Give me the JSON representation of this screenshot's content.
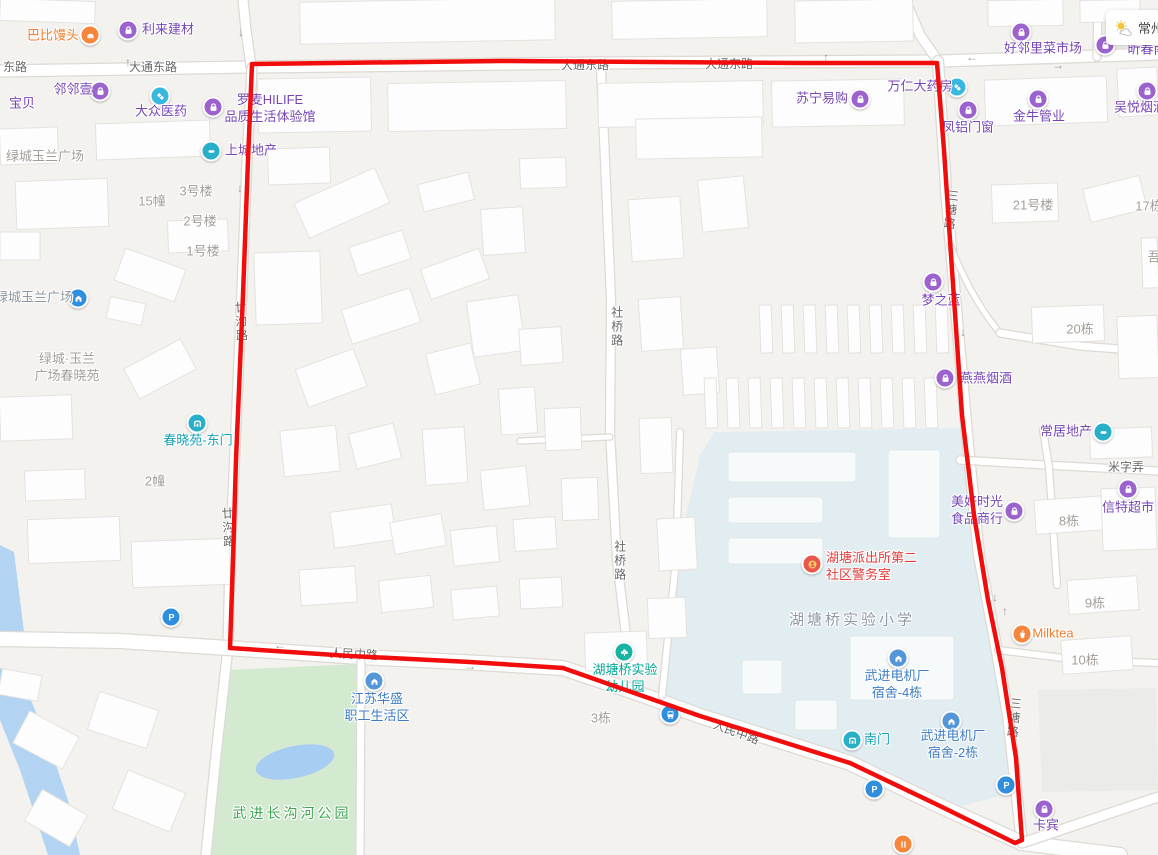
{
  "map": {
    "weather": {
      "city": "常州"
    },
    "red_route": {
      "path": "M252,64 L500,61 L800,63 L937,63 L944,150 L951,255 L962,415 L974,515 L988,600 L1002,668 L1016,758 L1022,840 L1015,843 L940,806 L850,763 L700,716 L563,668 L470,662 L350,656 L230,648 L233,560 L236,460 L243,295 L248,160 Z",
      "color": "#f20d0d"
    },
    "colors": {
      "purple": "#9c63cf",
      "blue": "#38b7df",
      "tealblue": "#29b0c8",
      "parkblue": "#2f8fde",
      "orange": "#f5863c",
      "blue2": "#5596d8",
      "tealgreen": "#19b3a4",
      "police": "#e8574a"
    },
    "labels": [
      {
        "t": "巴比馒头",
        "x": 53,
        "y": 36,
        "cls": "orange"
      },
      {
        "t": "利来建材",
        "x": 168,
        "y": 30,
        "cls": "purple"
      },
      {
        "t": "东路",
        "x": 15,
        "y": 68,
        "cls": "road"
      },
      {
        "t": "大通东路",
        "x": 153,
        "y": 68,
        "cls": "road"
      },
      {
        "t": "大通东路",
        "x": 585,
        "y": 66,
        "cls": "road"
      },
      {
        "t": "大通东路",
        "x": 729,
        "y": 65,
        "cls": "road"
      },
      {
        "t": "邻邻壹",
        "x": 73,
        "y": 90,
        "cls": "purple"
      },
      {
        "t": "宝贝",
        "x": 22,
        "y": 104,
        "cls": "purple"
      },
      {
        "t": "大众医药",
        "x": 161,
        "y": 112,
        "cls": "purple"
      },
      {
        "t": [
          "罗麦HILIFE",
          "品质生活体验馆"
        ],
        "x": 270,
        "y": 109,
        "cls": "purple"
      },
      {
        "t": "上城地产",
        "x": 251,
        "y": 151,
        "cls": "purple"
      },
      {
        "t": "绿城玉兰广场",
        "x": 45,
        "y": 157,
        "cls": "gray"
      },
      {
        "t": "15幢",
        "x": 152,
        "y": 202,
        "cls": "gray"
      },
      {
        "t": "3号楼",
        "x": 196,
        "y": 192,
        "cls": "gray"
      },
      {
        "t": "2号楼",
        "x": 200,
        "y": 222,
        "cls": "gray"
      },
      {
        "t": "1号楼",
        "x": 203,
        "y": 252,
        "cls": "gray"
      },
      {
        "t": "绿城玉兰广场",
        "x": 34,
        "y": 298,
        "cls": "grayblue"
      },
      {
        "t": [
          "绿城·玉兰",
          "广场春晓苑"
        ],
        "x": 67,
        "y": 368,
        "cls": "gray"
      },
      {
        "t": "春晓苑-东门",
        "x": 198,
        "y": 441,
        "cls": "teal"
      },
      {
        "t": "2幢",
        "x": 155,
        "y": 482,
        "cls": "gray"
      },
      {
        "t": "廿沟路",
        "x": 240,
        "y": 322,
        "cls": "road",
        "vert": true,
        "rot": -3
      },
      {
        "t": "廿沟路",
        "x": 227,
        "y": 528,
        "cls": "road",
        "vert": true,
        "rot": -3
      },
      {
        "t": "社桥路",
        "x": 616,
        "y": 327,
        "cls": "road",
        "vert": true
      },
      {
        "t": "社桥路",
        "x": 619,
        "y": 561,
        "cls": "road",
        "vert": true
      },
      {
        "t": "苏宁易购",
        "x": 822,
        "y": 99,
        "cls": "purple"
      },
      {
        "t": "万仁大药房",
        "x": 920,
        "y": 87,
        "cls": "purple"
      },
      {
        "t": "好邻里菜市场",
        "x": 1043,
        "y": 49,
        "cls": "purple"
      },
      {
        "t": "凤铝门窗",
        "x": 968,
        "y": 128,
        "cls": "purple"
      },
      {
        "t": "金牛管业",
        "x": 1039,
        "y": 117,
        "cls": "purple"
      },
      {
        "t": "吴悦烟酒",
        "x": 1140,
        "y": 108,
        "cls": "purple"
      },
      {
        "t": "昕春南",
        "x": 1147,
        "y": 50,
        "cls": "purple"
      },
      {
        "t": "三塘路",
        "x": 950,
        "y": 210,
        "cls": "road",
        "vert": true,
        "rot": 7
      },
      {
        "t": "三塘路",
        "x": 1013,
        "y": 718,
        "cls": "road",
        "vert": true,
        "rot": 6
      },
      {
        "t": "21号楼",
        "x": 1033,
        "y": 206,
        "cls": "gray"
      },
      {
        "t": "17栋",
        "x": 1149,
        "y": 207,
        "cls": "gray"
      },
      {
        "t": "吾",
        "x": 1154,
        "y": 258,
        "cls": "gray"
      },
      {
        "t": "梦之蓝",
        "x": 941,
        "y": 301,
        "cls": "purple"
      },
      {
        "t": "20栋",
        "x": 1080,
        "y": 330,
        "cls": "gray"
      },
      {
        "t": "燕燕烟酒",
        "x": 986,
        "y": 379,
        "cls": "purple"
      },
      {
        "t": "常居地产",
        "x": 1066,
        "y": 432,
        "cls": "purple"
      },
      {
        "t": "米字弄",
        "x": 1126,
        "y": 468,
        "cls": "road"
      },
      {
        "t": "信特超市",
        "x": 1128,
        "y": 508,
        "cls": "purple"
      },
      {
        "t": [
          "美好时光",
          "食品商行"
        ],
        "x": 977,
        "y": 511,
        "cls": "purple"
      },
      {
        "t": "8栋",
        "x": 1069,
        "y": 522,
        "cls": "gray"
      },
      {
        "t": "9栋",
        "x": 1095,
        "y": 604,
        "cls": "gray"
      },
      {
        "t": "Milktea",
        "x": 1053,
        "y": 634,
        "cls": "orange"
      },
      {
        "t": "10栋",
        "x": 1085,
        "y": 661,
        "cls": "gray"
      },
      {
        "t": [
          "湖塘派出所第二",
          "社区警务室"
        ],
        "x": 869,
        "y": 567,
        "cls": "redtx",
        "align": "l"
      },
      {
        "t": "湖塘桥实验小学",
        "x": 852,
        "y": 620,
        "cls": "schoolgray"
      },
      {
        "t": [
          "武进电机厂",
          "宿舍-4栋"
        ],
        "x": 897,
        "y": 685,
        "cls": "blue"
      },
      {
        "t": "南门",
        "x": 877,
        "y": 740,
        "cls": "teal"
      },
      {
        "t": [
          "武进电机厂",
          "宿舍-2栋"
        ],
        "x": 953,
        "y": 745,
        "cls": "blue"
      },
      {
        "t": "卡宾",
        "x": 1046,
        "y": 826,
        "cls": "purple"
      },
      {
        "t": [
          "湖塘桥实验",
          "幼儿园"
        ],
        "x": 625,
        "y": 679,
        "cls": "tealgreen"
      },
      {
        "t": "人民中路",
        "x": 736,
        "y": 733,
        "cls": "road",
        "rot": 20
      },
      {
        "t": "人民中路",
        "x": 354,
        "y": 655,
        "cls": "road",
        "rot": 3
      },
      {
        "t": "3栋",
        "x": 601,
        "y": 719,
        "cls": "gray"
      },
      {
        "t": [
          "江苏华盛",
          "职工生活区"
        ],
        "x": 377,
        "y": 708,
        "cls": "blue"
      },
      {
        "t": "武进长沟河公园",
        "x": 292,
        "y": 813,
        "cls": "green"
      }
    ],
    "icons": [
      {
        "type": "bun",
        "x": 90,
        "y": 35,
        "c": "orange"
      },
      {
        "type": "bag",
        "x": 128,
        "y": 30,
        "c": "purple"
      },
      {
        "type": "bag",
        "x": 100,
        "y": 91,
        "c": "purple"
      },
      {
        "type": "pill",
        "x": 160,
        "y": 96,
        "c": "blue"
      },
      {
        "type": "bag",
        "x": 213,
        "y": 107,
        "c": "purple"
      },
      {
        "type": "bar",
        "x": 211,
        "y": 151,
        "c": "tealblue"
      },
      {
        "type": "house",
        "x": 78,
        "y": 298,
        "c": "parkblue"
      },
      {
        "type": "gate",
        "x": 197,
        "y": 423,
        "c": "tealblue"
      },
      {
        "type": "parking",
        "x": 171,
        "y": 617,
        "c": "parkblue"
      },
      {
        "type": "bag",
        "x": 860,
        "y": 99,
        "c": "purple"
      },
      {
        "type": "pill",
        "x": 957,
        "y": 87,
        "c": "blue"
      },
      {
        "type": "bag",
        "x": 1021,
        "y": 32,
        "c": "purple"
      },
      {
        "type": "bag",
        "x": 1105,
        "y": 45,
        "c": "purple"
      },
      {
        "type": "bag",
        "x": 968,
        "y": 110,
        "c": "purple"
      },
      {
        "type": "bag",
        "x": 1038,
        "y": 99,
        "c": "purple"
      },
      {
        "type": "bag",
        "x": 1147,
        "y": 91,
        "c": "purple"
      },
      {
        "type": "bag",
        "x": 933,
        "y": 282,
        "c": "purple"
      },
      {
        "type": "bag",
        "x": 945,
        "y": 378,
        "c": "purple"
      },
      {
        "type": "bar",
        "x": 1103,
        "y": 432,
        "c": "tealblue"
      },
      {
        "type": "bag",
        "x": 1128,
        "y": 489,
        "c": "purple"
      },
      {
        "type": "bag",
        "x": 1014,
        "y": 511,
        "c": "purple"
      },
      {
        "type": "cup",
        "x": 1022,
        "y": 634,
        "c": "orange"
      },
      {
        "type": "police",
        "x": 812,
        "y": 564,
        "c": "police"
      },
      {
        "type": "factory",
        "x": 898,
        "y": 658,
        "c": "blue2"
      },
      {
        "type": "gate",
        "x": 852,
        "y": 740,
        "c": "tealblue"
      },
      {
        "type": "factory",
        "x": 951,
        "y": 721,
        "c": "blue2"
      },
      {
        "type": "parking",
        "x": 874,
        "y": 789,
        "c": "parkblue"
      },
      {
        "type": "parking",
        "x": 1006,
        "y": 785,
        "c": "parkblue"
      },
      {
        "type": "bag",
        "x": 1044,
        "y": 809,
        "c": "purple"
      },
      {
        "type": "fork",
        "x": 903,
        "y": 844,
        "c": "orange"
      },
      {
        "type": "tree",
        "x": 624,
        "y": 652,
        "c": "tealgreen"
      },
      {
        "type": "bus",
        "x": 670,
        "y": 714,
        "c": "parkblue"
      },
      {
        "type": "factory",
        "x": 374,
        "y": 681,
        "c": "blue2"
      }
    ],
    "arrows": [
      {
        "g": "↑",
        "x": 128,
        "y": 62
      },
      {
        "g": "↓",
        "x": 241,
        "y": 32
      },
      {
        "g": "↓",
        "x": 240,
        "y": 188
      },
      {
        "g": "↓",
        "x": 946,
        "y": 182
      },
      {
        "g": "↓",
        "x": 963,
        "y": 332
      },
      {
        "g": "↓",
        "x": 995,
        "y": 597
      },
      {
        "g": "↑",
        "x": 1005,
        "y": 611
      },
      {
        "g": "↓",
        "x": 1018,
        "y": 799
      },
      {
        "g": "←",
        "x": 972,
        "y": 57
      },
      {
        "g": "→",
        "x": 1058,
        "y": 65
      },
      {
        "g": "←",
        "x": 280,
        "y": 645
      },
      {
        "g": "→",
        "x": 470,
        "y": 666
      },
      {
        "g": "↑",
        "x": 826,
        "y": 57
      }
    ]
  }
}
